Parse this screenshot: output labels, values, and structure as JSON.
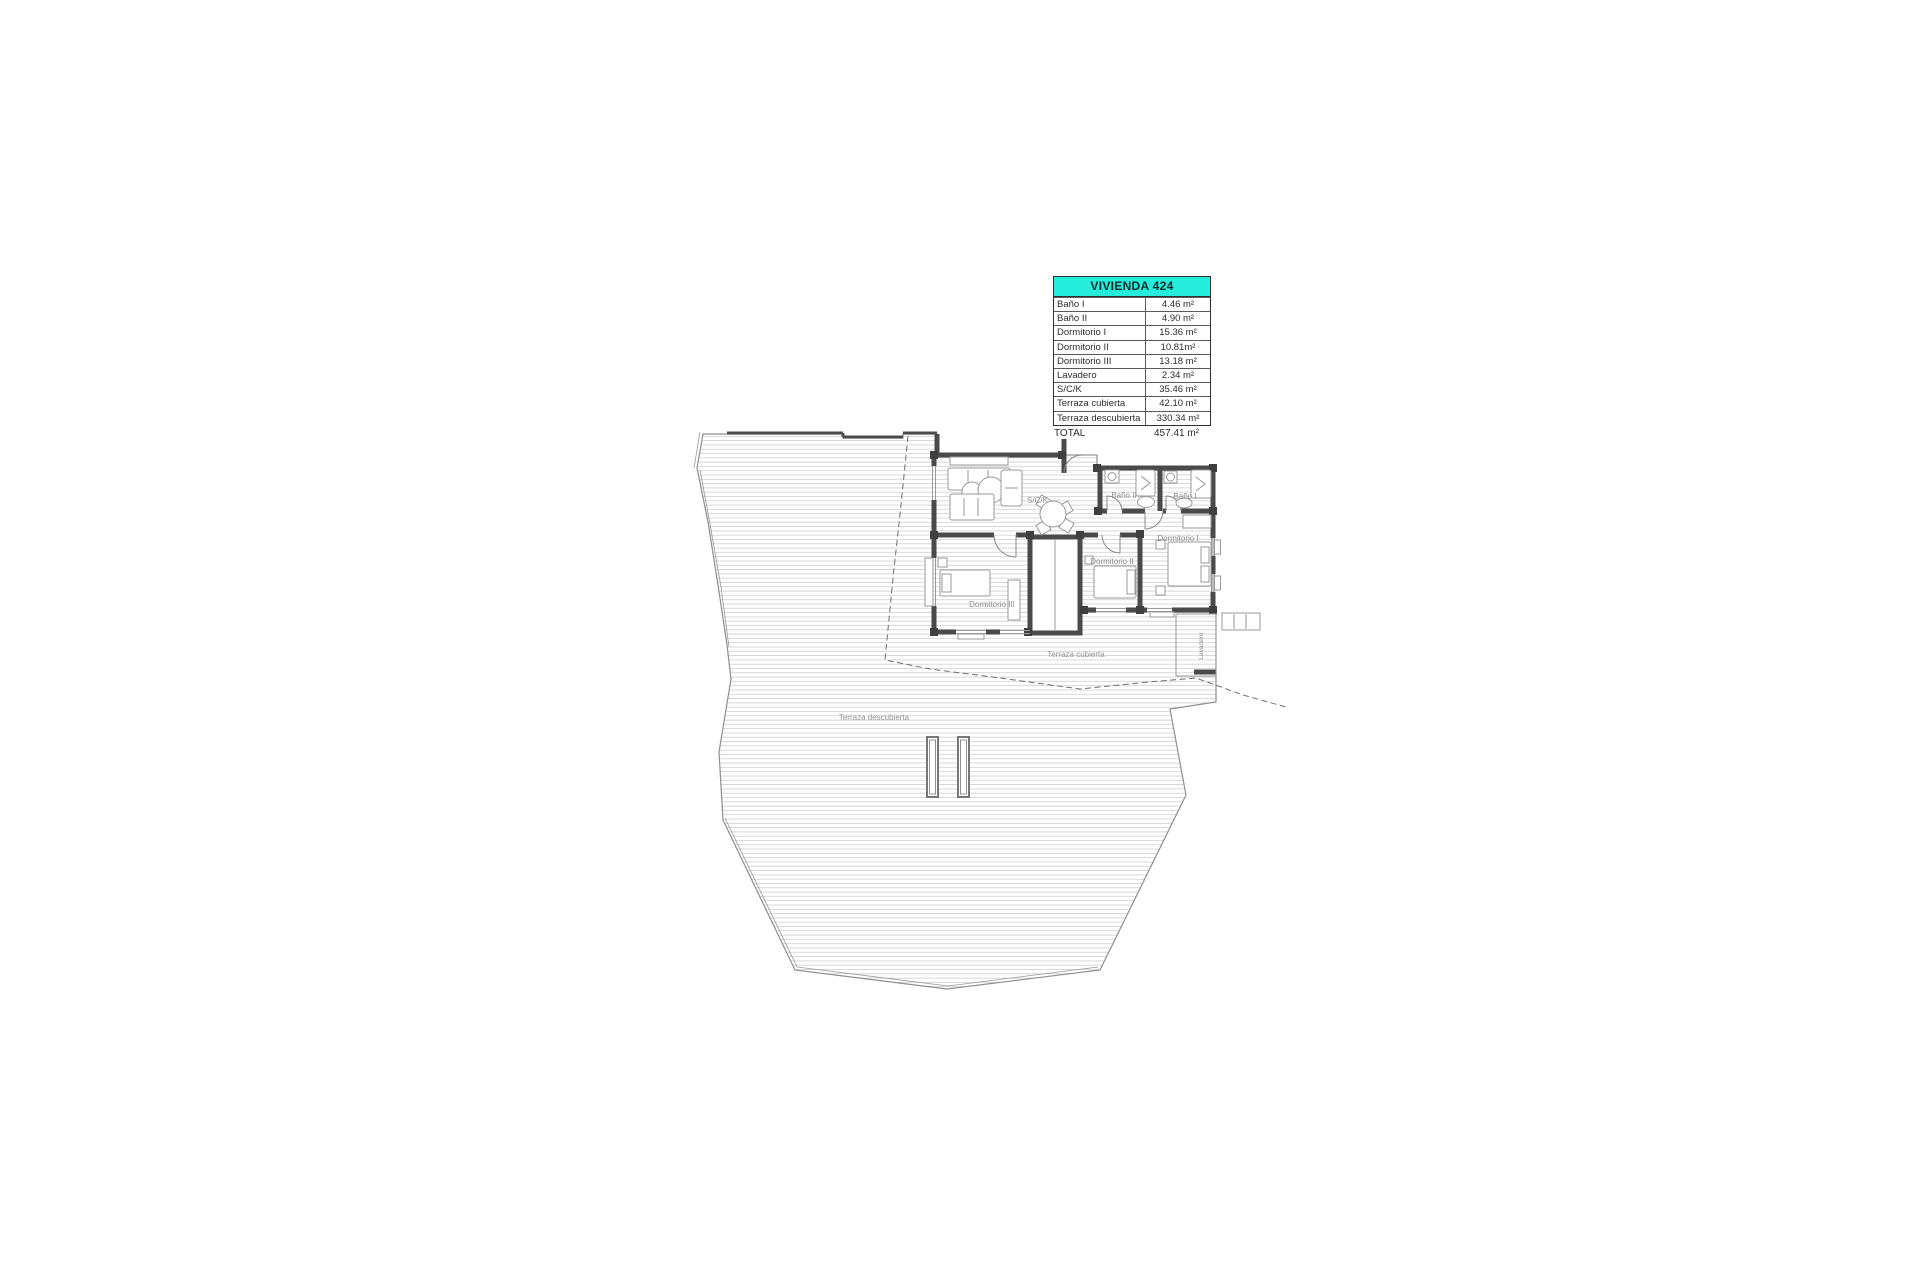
{
  "window": {
    "background": "#ffffff",
    "description": "Architectural floor plan sheet"
  },
  "table": {
    "title": "VIVIENDA 424",
    "header_bg": "#24EDDC",
    "rows": [
      {
        "label": "Baño I",
        "value": "4.46 m²"
      },
      {
        "label": "Baño II",
        "value": "4.90 m²"
      },
      {
        "label": "Dormitorio I",
        "value": "15.36 m²"
      },
      {
        "label": "Dormitorio II",
        "value": "10.81m²"
      },
      {
        "label": "Dormitorio III",
        "value": "13.18 m²"
      },
      {
        "label": "Lavadero",
        "value": "2.34 m²"
      },
      {
        "label": "S/C/K",
        "value": "35.46 m²"
      },
      {
        "label": "Terraza cubierta",
        "value": "42.10 m²"
      },
      {
        "label": "Terraza descubierta",
        "value": "330.34 m²"
      }
    ],
    "total": {
      "label": "TOTAL",
      "value": "457.41 m²"
    }
  },
  "plan": {
    "labels": {
      "sck": "S/C/K",
      "bano1": "Baño I",
      "bano2": "Baño II",
      "dorm1": "Dormitorio I",
      "dorm2": "Dormitorio II",
      "dorm3": "Dormitorio III",
      "lavadero": "Lavadero",
      "terraza_cubierta": "Terraza cubierta",
      "terraza_descubierta": "Terraza descubierta"
    },
    "colors": {
      "wall": "#4a4a4a",
      "outline": "#8f8f8f",
      "hatch_line": "#cccccc",
      "dashed_line": "#6f6f6f",
      "label_text": "#8f8f8f"
    }
  }
}
